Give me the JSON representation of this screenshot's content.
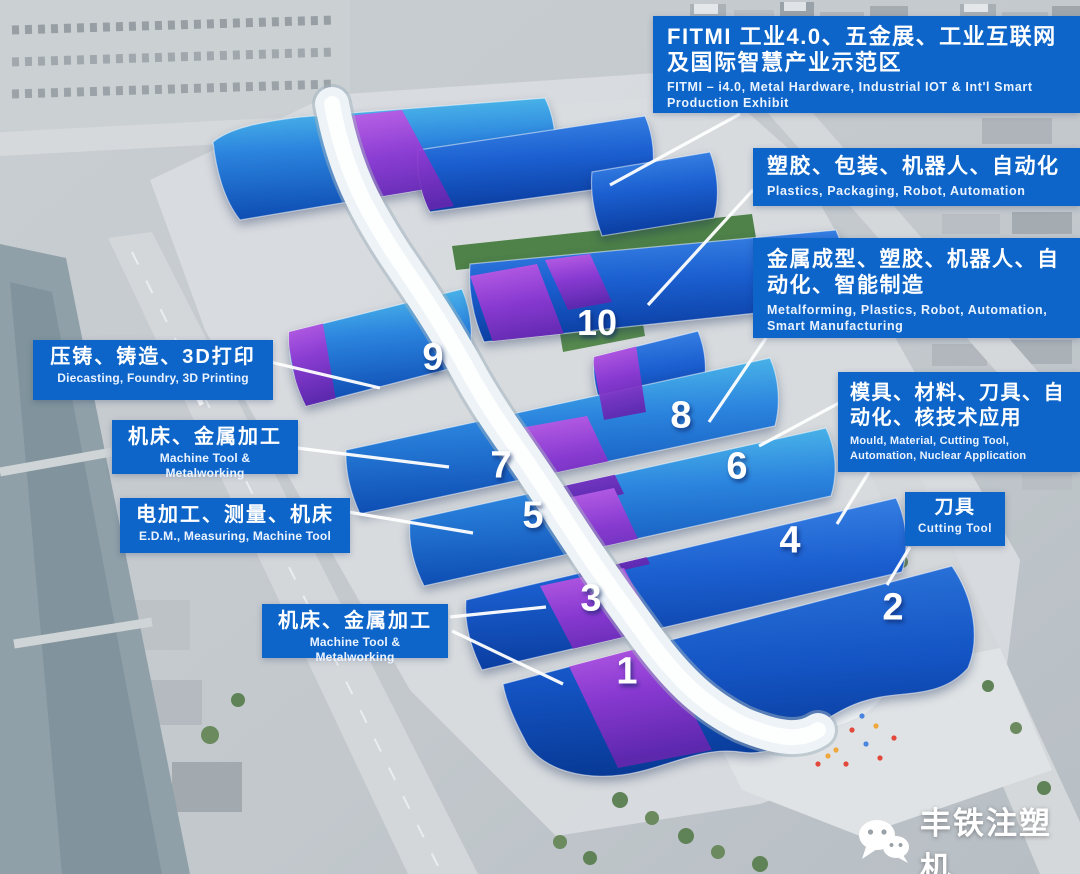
{
  "title": "Exhibition venue hall map",
  "colors": {
    "label_bg": "#0d65c9",
    "roof_blue": "#1b5fd0",
    "roof_cyan": "#56c6ec",
    "roof_purple": "#9338d2",
    "spine_white": "#edf3f7"
  },
  "labels": {
    "fitmi": {
      "cn": "FITMI 工业4.0、五金展、工业互联网及国际智慧产业示范区",
      "en": "FITMI – i4.0, Metal Hardware, Industrial IOT & Int'l Smart Production Exhibit"
    },
    "plastics": {
      "cn": "塑胶、包装、机器人、自动化",
      "en": "Plastics, Packaging, Robot, Automation"
    },
    "metalforming": {
      "cn": "金属成型、塑胶、机器人、自动化、智能制造",
      "en": "Metalforming, Plastics, Robot, Automation, Smart Manufacturing"
    },
    "mould": {
      "cn": "模具、材料、刀具、自动化、核技术应用",
      "en": "Mould, Material, Cutting Tool, Automation, Nuclear Application"
    },
    "cutting": {
      "cn": "刀具",
      "en": "Cutting Tool"
    },
    "diecasting": {
      "cn": "压铸、铸造、3D打印",
      "en": "Diecasting, Foundry, 3D Printing"
    },
    "machinetool_top": {
      "cn": "机床、金属加工",
      "en": "Machine Tool & Metalworking"
    },
    "edm": {
      "cn": "电加工、测量、机床",
      "en": "E.D.M., Measuring, Machine Tool"
    },
    "machinetool_bottom": {
      "cn": "机床、金属加工",
      "en": "Machine Tool & Metalworking"
    }
  },
  "halls": [
    {
      "number": "1"
    },
    {
      "number": "2"
    },
    {
      "number": "3"
    },
    {
      "number": "4"
    },
    {
      "number": "5"
    },
    {
      "number": "6"
    },
    {
      "number": "7"
    },
    {
      "number": "8"
    },
    {
      "number": "9"
    },
    {
      "number": "10"
    }
  ],
  "watermark": {
    "icon": "wechat-icon",
    "text": "丰铁注塑机"
  }
}
